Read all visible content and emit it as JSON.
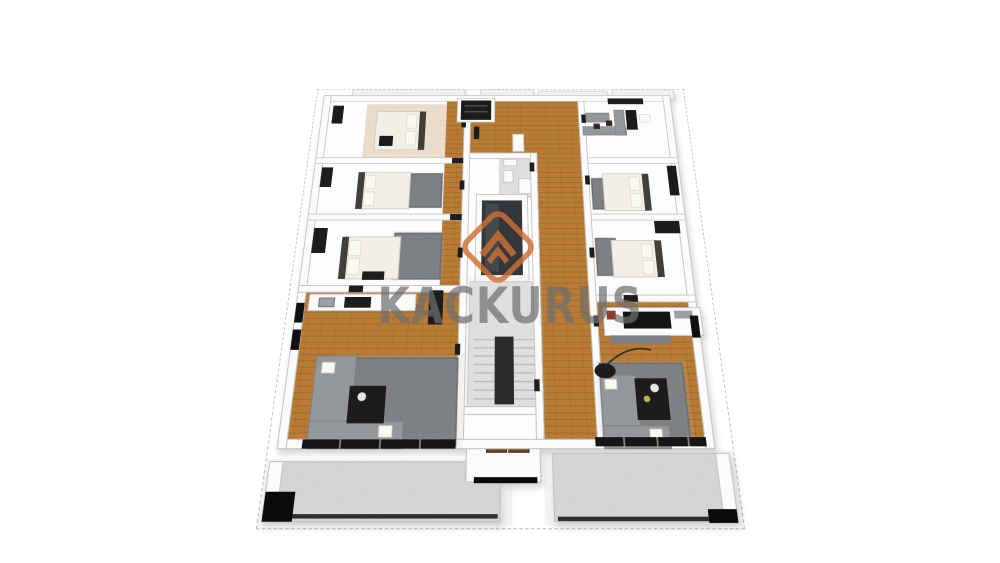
{
  "watermark": {
    "text": "KACKURUS",
    "logo": "diamond-roof-logo"
  },
  "colors": {
    "background": "#ffffff",
    "logo_orange": "#cf6e35",
    "watermark_text": "#6f6f6f",
    "wood_floor": "#b97c36",
    "wood_line": "#8a5a22",
    "wall_fill": "#fbfbfb",
    "wall_edge": "#c6c6c6",
    "carpet_gray": "#73767a",
    "balcony_tile": "#d8d8d6",
    "fixture_dark": "#1c1c1c",
    "sofa_gray": "#94979b",
    "bed_white": "#f2efe7",
    "headboard_dark": "#433e37",
    "stair_tile": "#e3e3e1",
    "entry_door_brown": "#774a20",
    "shadow_black": "#0a0a0a"
  }
}
